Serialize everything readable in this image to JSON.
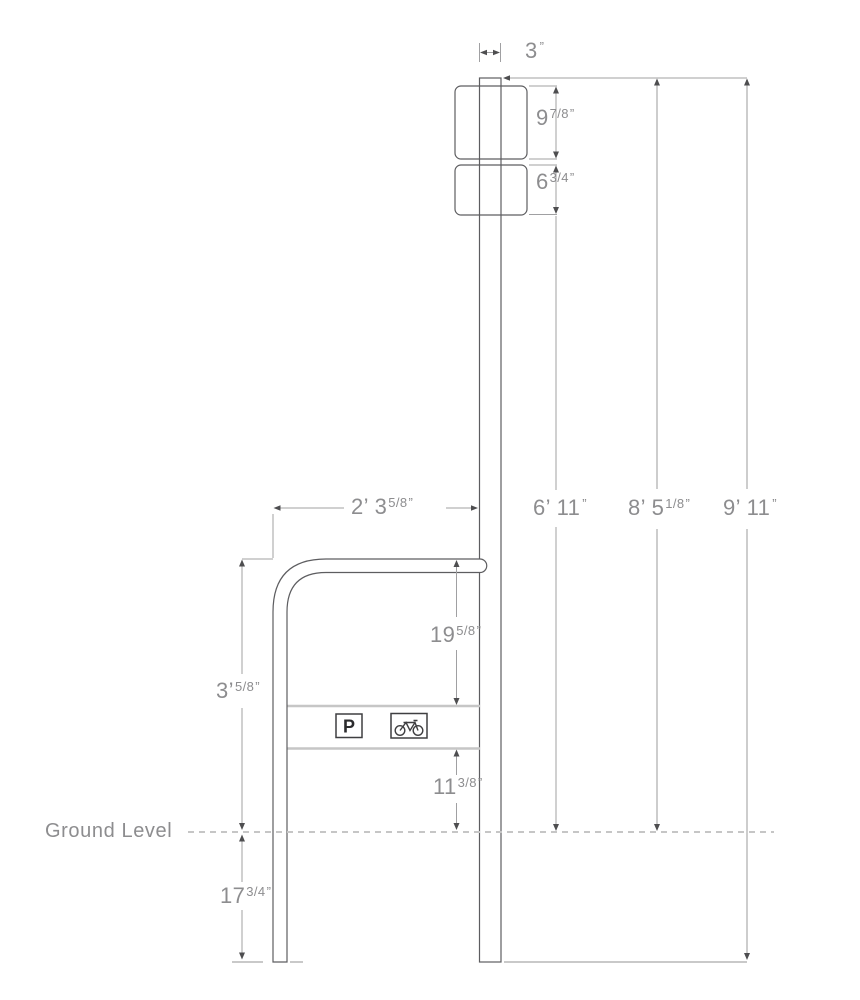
{
  "ground": {
    "label": "Ground Level"
  },
  "signs": {
    "parking_letter": "P",
    "bike_icon": "bicycle-icon"
  },
  "dimensions": {
    "post_width": {
      "pre": "3",
      "frac": "",
      "quote": "”"
    },
    "upper_sign_height": {
      "pre": "9",
      "frac": "7/8",
      "quote": "”"
    },
    "lower_sign_height": {
      "pre": "6",
      "frac": "3/4",
      "quote": "”"
    },
    "rack_width": {
      "pre": "2’ 3",
      "frac": "5/8",
      "quote": "”"
    },
    "sign_clearance": {
      "pre": "6’ 11",
      "frac": "",
      "quote": "”"
    },
    "post_height_above_ground": {
      "pre": "8’ 5",
      "frac": "1/8",
      "quote": "”"
    },
    "post_total_height": {
      "pre": "9’ 11",
      "frac": "",
      "quote": "”"
    },
    "rack_top_to_plate": {
      "pre": "19",
      "frac": "5/8",
      "quote": "”"
    },
    "rack_height": {
      "pre": "3’",
      "frac": "5/8",
      "quote": "”"
    },
    "plate_to_ground": {
      "pre": "11",
      "frac": "3/8",
      "quote": "”"
    },
    "below_ground_depth": {
      "pre": "17",
      "frac": "3/4",
      "quote": "”"
    }
  },
  "colors": {
    "outline": "#5d5d60",
    "dim_line": "#a0a0a2",
    "dim_line_light": "#cdcdcd",
    "arrow": "#4e4e50",
    "text": "#8d8d8f",
    "plate_line": "#c6c6c6",
    "ground_dash": "#c6c6c6"
  }
}
